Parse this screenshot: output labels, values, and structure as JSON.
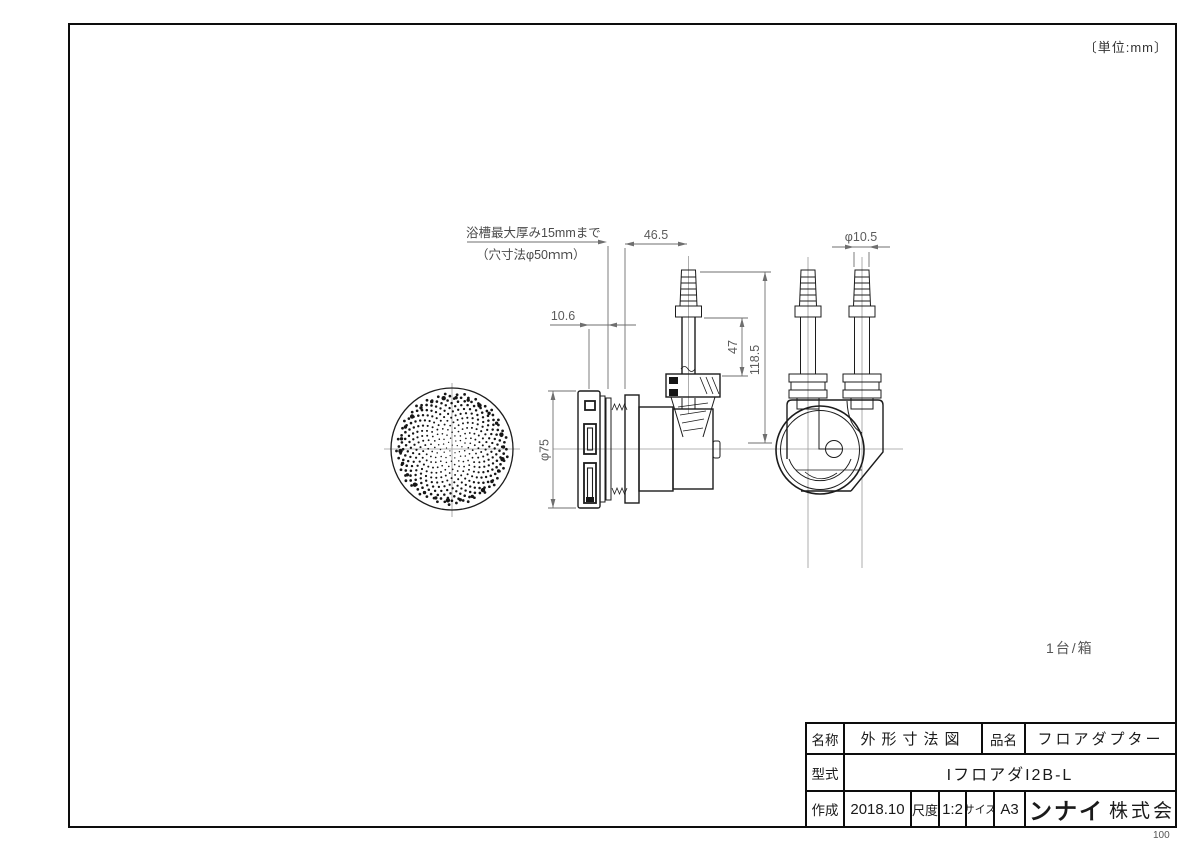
{
  "page": {
    "unit_note": "〔単位:mm〕",
    "quantity_note": "1台/箱",
    "page_number": "100"
  },
  "annotations": {
    "tub_note_line1": "浴槽最大厚み15mmまで",
    "tub_note_line2": "（穴寸法φ50ｍｍ）"
  },
  "dimensions": {
    "width_46_5": "46.5",
    "dia_10_5": "φ10.5",
    "offset_10_6": "10.6",
    "height_47": "47",
    "height_118_5": "118.5",
    "dia_75": "φ75"
  },
  "title_block": {
    "name_label": "名称",
    "name_value": "外形寸法図",
    "product_label": "品名",
    "product_value": "フロアダプター",
    "model_label": "型式",
    "model_value": "IフロアダI2B-L",
    "date_label": "作成",
    "date_value": "2018.10",
    "scale_label": "尺度",
    "scale_value": "1:2",
    "size_label": "サイズ",
    "size_value": "A3",
    "company_brand": "リンナイ",
    "company_suffix": "株式会社"
  },
  "style": {
    "ink_color": "#1c1c1c",
    "dimension_color": "#6f6f6f",
    "centerline_color": "#9a9a9a"
  }
}
